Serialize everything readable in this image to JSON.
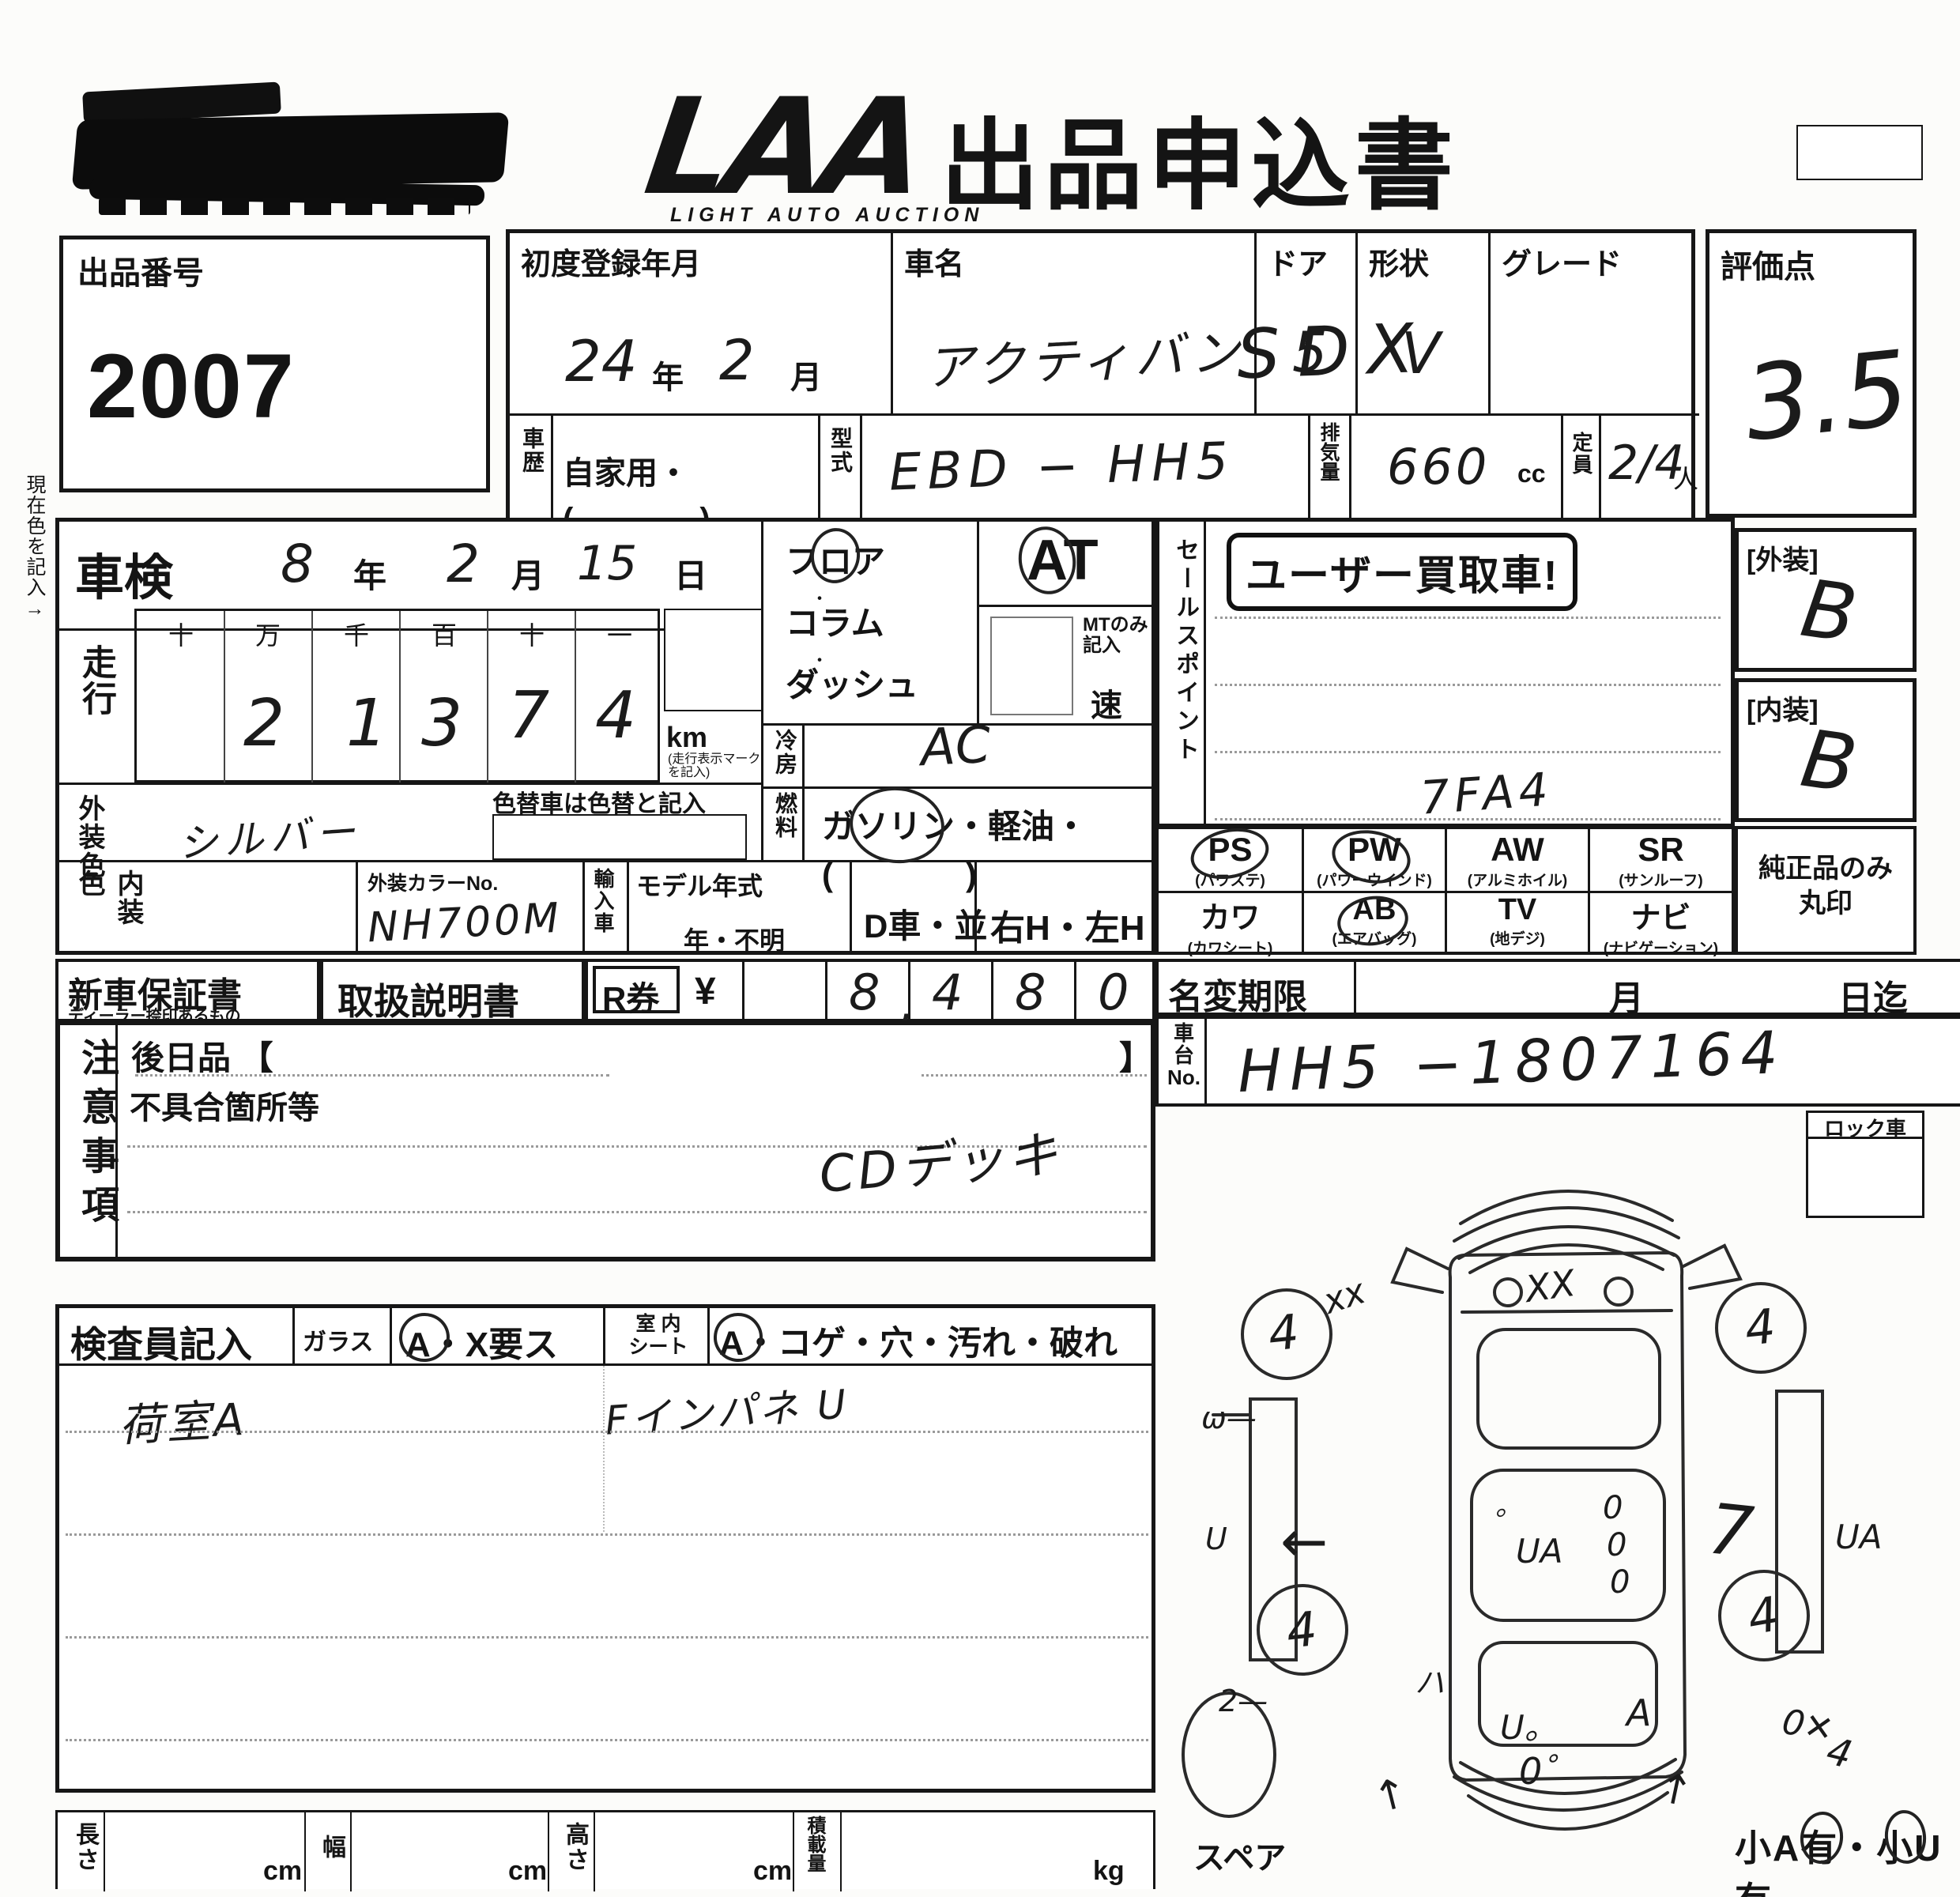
{
  "header": {
    "brand": "LAA",
    "brand_sub": "LIGHT AUTO AUCTION",
    "title": "出品申込書"
  },
  "lot": {
    "label": "出品番号",
    "value": "2007"
  },
  "registration": {
    "label": "初度登録年月",
    "year": "24",
    "year_suffix": "年",
    "month": "2",
    "month_suffix": "月"
  },
  "car_name": {
    "label": "車名",
    "value": "アクティバン"
  },
  "doors": {
    "label": "ドア",
    "value": "5"
  },
  "shape": {
    "label": "形状",
    "value": "V"
  },
  "grade": {
    "label": "グレード",
    "value": "SDX"
  },
  "score": {
    "label": "評価点",
    "value": "3.5"
  },
  "history": {
    "label": "車歴",
    "value": "自家用・(　　　　)"
  },
  "model_code": {
    "label": "型式",
    "value": "EBD − HH5"
  },
  "displacement": {
    "label": "排気量",
    "value": "660",
    "unit": "cc"
  },
  "capacity": {
    "label": "定員",
    "value": "2/4",
    "unit": "人"
  },
  "shaken": {
    "label": "車検",
    "year": "8",
    "year_suffix": "年",
    "month": "2",
    "month_suffix": "月",
    "day": "15",
    "day_suffix": "日"
  },
  "mileage": {
    "label": "走行",
    "digit_headers": [
      "十",
      "万",
      "千",
      "百",
      "十",
      "一"
    ],
    "digits": [
      "",
      "2",
      "1",
      "3",
      "7",
      "4"
    ],
    "unit": "km",
    "unit_note": "(走行表示マーク を記入)"
  },
  "current_color_note": "現在色を記入→",
  "exterior_color": {
    "label": "外装色",
    "value": "シルバー",
    "recolor_note": "色替車は色替と記入"
  },
  "interior_color": {
    "label": "内装色",
    "value": ""
  },
  "color_no": {
    "label": "外装カラーNo.",
    "value": "NH700M"
  },
  "import_car": {
    "label": "輸入車"
  },
  "model_year": {
    "label": "モデル年式",
    "value": "年・不明"
  },
  "shift": {
    "line1": "フロア",
    "line2": "コラム",
    "line3": "ダッシュ",
    "at_label": "AT",
    "selected": "AT / フロア",
    "mt_note1": "MTのみ",
    "mt_note2": "記入",
    "speed_suffix": "速"
  },
  "aircon": {
    "label": "冷房",
    "value": "AC"
  },
  "fuel": {
    "label": "燃料",
    "text": "ガソリン・軽油・(　　　　)",
    "selected": "ガソリン"
  },
  "dealer_cell": "D車・並",
  "handle_cell": "右H・左H",
  "sales_point": {
    "label": "セールスポイント",
    "stamp": "ユーザー買取車!",
    "note": "7FA4"
  },
  "equipment": {
    "items": [
      {
        "code": "PS",
        "name": "(パワステ)",
        "circled": true
      },
      {
        "code": "PW",
        "name": "(パワーウインド)",
        "circled": true
      },
      {
        "code": "AW",
        "name": "(アルミホイル)",
        "circled": false
      },
      {
        "code": "SR",
        "name": "(サンルーフ)",
        "circled": false
      },
      {
        "code": "カワ",
        "name": "(カワシート)",
        "circled": false
      },
      {
        "code": "AB",
        "name": "(エアバッグ)",
        "circled": true
      },
      {
        "code": "TV",
        "name": "(地デジ)",
        "circled": false
      },
      {
        "code": "ナビ",
        "name": "(ナビゲーション)",
        "circled": false
      }
    ],
    "genuine_note1": "純正品のみ",
    "genuine_note2": "丸印"
  },
  "exterior_grade": {
    "label": "[外装]",
    "value": "B"
  },
  "interior_grade": {
    "label": "[内装]",
    "value": "B"
  },
  "warranty": {
    "label": "新車保証書",
    "sub": "ディーラー捺印あるもの"
  },
  "manual": {
    "label": "取扱説明書"
  },
  "recycle": {
    "label": "R券",
    "currency": "¥",
    "digits": [
      "",
      "8",
      "4",
      "8",
      "0"
    ],
    "comma": ",",
    "value": "8,480"
  },
  "name_change": {
    "label": "名変期限",
    "month_suffix": "月",
    "day_suffix": "日迄"
  },
  "chassis": {
    "label1": "車台",
    "label2": "No.",
    "value": "HH5 −1807164"
  },
  "notes": {
    "label": "注意事項",
    "later_items": "後日品 【",
    "bracket_close": "】",
    "defects": "不具合箇所等",
    "note": "CDデッキ"
  },
  "lock": {
    "label": "ロック車"
  },
  "inspector": {
    "label": "検査員記入",
    "glass_label": "ガラス",
    "glass_value": "A・X要ス",
    "seat_label1": "室 内",
    "seat_label2": "シート",
    "seat_value": "A・コゲ・穴・汚れ・破れ",
    "cargo_note": "荷室A",
    "panel_note": "Fインパネ U"
  },
  "dimensions": {
    "length_label": "長さ",
    "width_label": "幅",
    "height_label": "高さ",
    "load_label": "積載量",
    "cm": "cm",
    "kg": "kg"
  },
  "diagram": {
    "spare_label": "スペア",
    "bottom_note": "小A有・小U有",
    "marks": [
      "xx",
      "XX",
      "4",
      "4",
      "4",
      "4",
      "ω—",
      "U",
      "←",
      "。",
      "UA",
      "0",
      "0",
      "0",
      "7",
      "UA",
      "ハ",
      "2—",
      "U。",
      "0゜",
      "A",
      "0✕",
      "4",
      "↑",
      "↑"
    ]
  }
}
